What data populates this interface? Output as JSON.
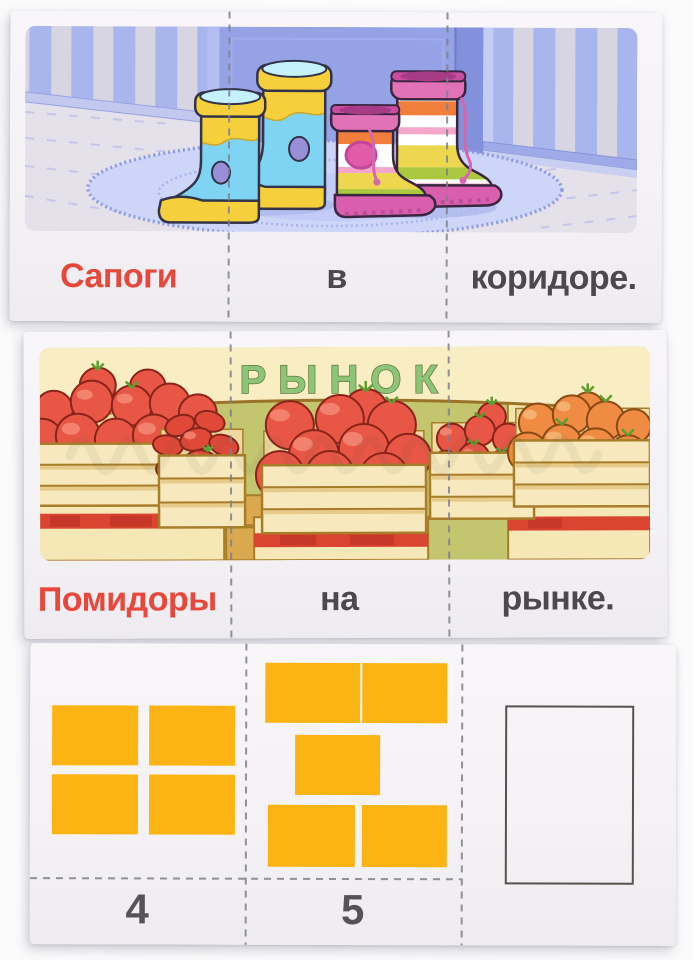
{
  "page": {
    "background_color": "#fcfbfc"
  },
  "cards": [
    {
      "id": "boots-sentence-card",
      "type": "sentence-card",
      "scene": {
        "name": "rubber-boots-in-hallway-on-rug"
      },
      "segments": [
        {
          "word": "Сапоги",
          "emphasis": true
        },
        {
          "word": "в",
          "emphasis": false
        },
        {
          "word": "коридоре.",
          "emphasis": false
        }
      ]
    },
    {
      "id": "market-sentence-card",
      "type": "sentence-card",
      "scene": {
        "name": "tomato-crates-at-market",
        "sign": "РЫНОК"
      },
      "segments": [
        {
          "word": "Помидоры",
          "emphasis": true
        },
        {
          "word": "на",
          "emphasis": false
        },
        {
          "word": "рынке.",
          "emphasis": false
        }
      ]
    },
    {
      "id": "counting-card",
      "type": "counting-card",
      "sections": [
        {
          "tiles": 4,
          "label": "4",
          "empty_frame": false
        },
        {
          "tiles": 5,
          "label": "5",
          "empty_frame": false
        },
        {
          "tiles": 0,
          "label": "",
          "empty_frame": true
        }
      ]
    }
  ],
  "colors": {
    "emphasis_red": "#e8473c",
    "word_dark": "#4b484e",
    "tile_yellow": "#fbb414",
    "sign_green": "#8cc478",
    "dash_gray": "#7f7f89",
    "tomato_red": "#e85745",
    "tomato_orange": "#ef8b42",
    "crate_wood": "#f7e9bd"
  }
}
